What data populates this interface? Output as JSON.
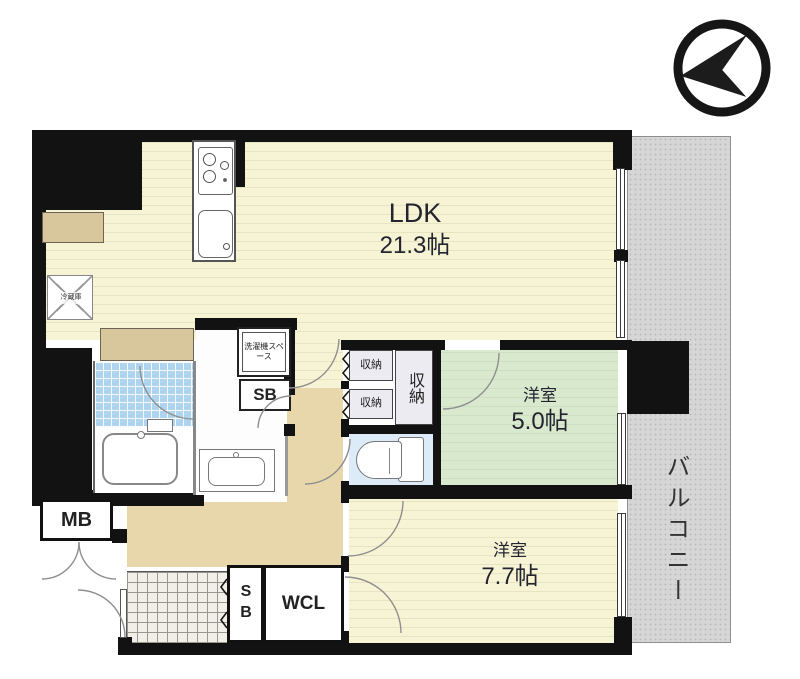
{
  "plan_title": "間取り図",
  "compass": {
    "icon": "compass-arrow-icon"
  },
  "rooms": {
    "ldk": {
      "label": "LDK",
      "size": "21.3帖"
    },
    "bedroom_small": {
      "label": "洋室",
      "size": "5.0帖"
    },
    "bedroom_large": {
      "label": "洋室",
      "size": "7.7帖"
    },
    "balcony": {
      "label": "バルコニー"
    }
  },
  "fixtures": {
    "meter_box": "MB",
    "walk_in_closet": "WCL",
    "shoe_box_entrance": "SB",
    "storage_box_washroom": "SB",
    "closet_top": "収納",
    "closet_bottom": "収納",
    "closet_large": "収納",
    "washing_machine_space": "洗濯機スペース",
    "refrigerator": "冷蔵庫"
  },
  "colors": {
    "wall": "#121212",
    "ldk_floor": "#f7f4d6",
    "bedroom_small_floor": "#d9e9ce",
    "bedroom_large_floor": "#f7f4d6",
    "hallway_floor": "#e7d7ab",
    "counter": "#d8c69c",
    "bath_tile": "#aed4ef",
    "toilet_floor": "#dcebf7",
    "balcony": "#d6d6d6",
    "text": "#23242e"
  }
}
